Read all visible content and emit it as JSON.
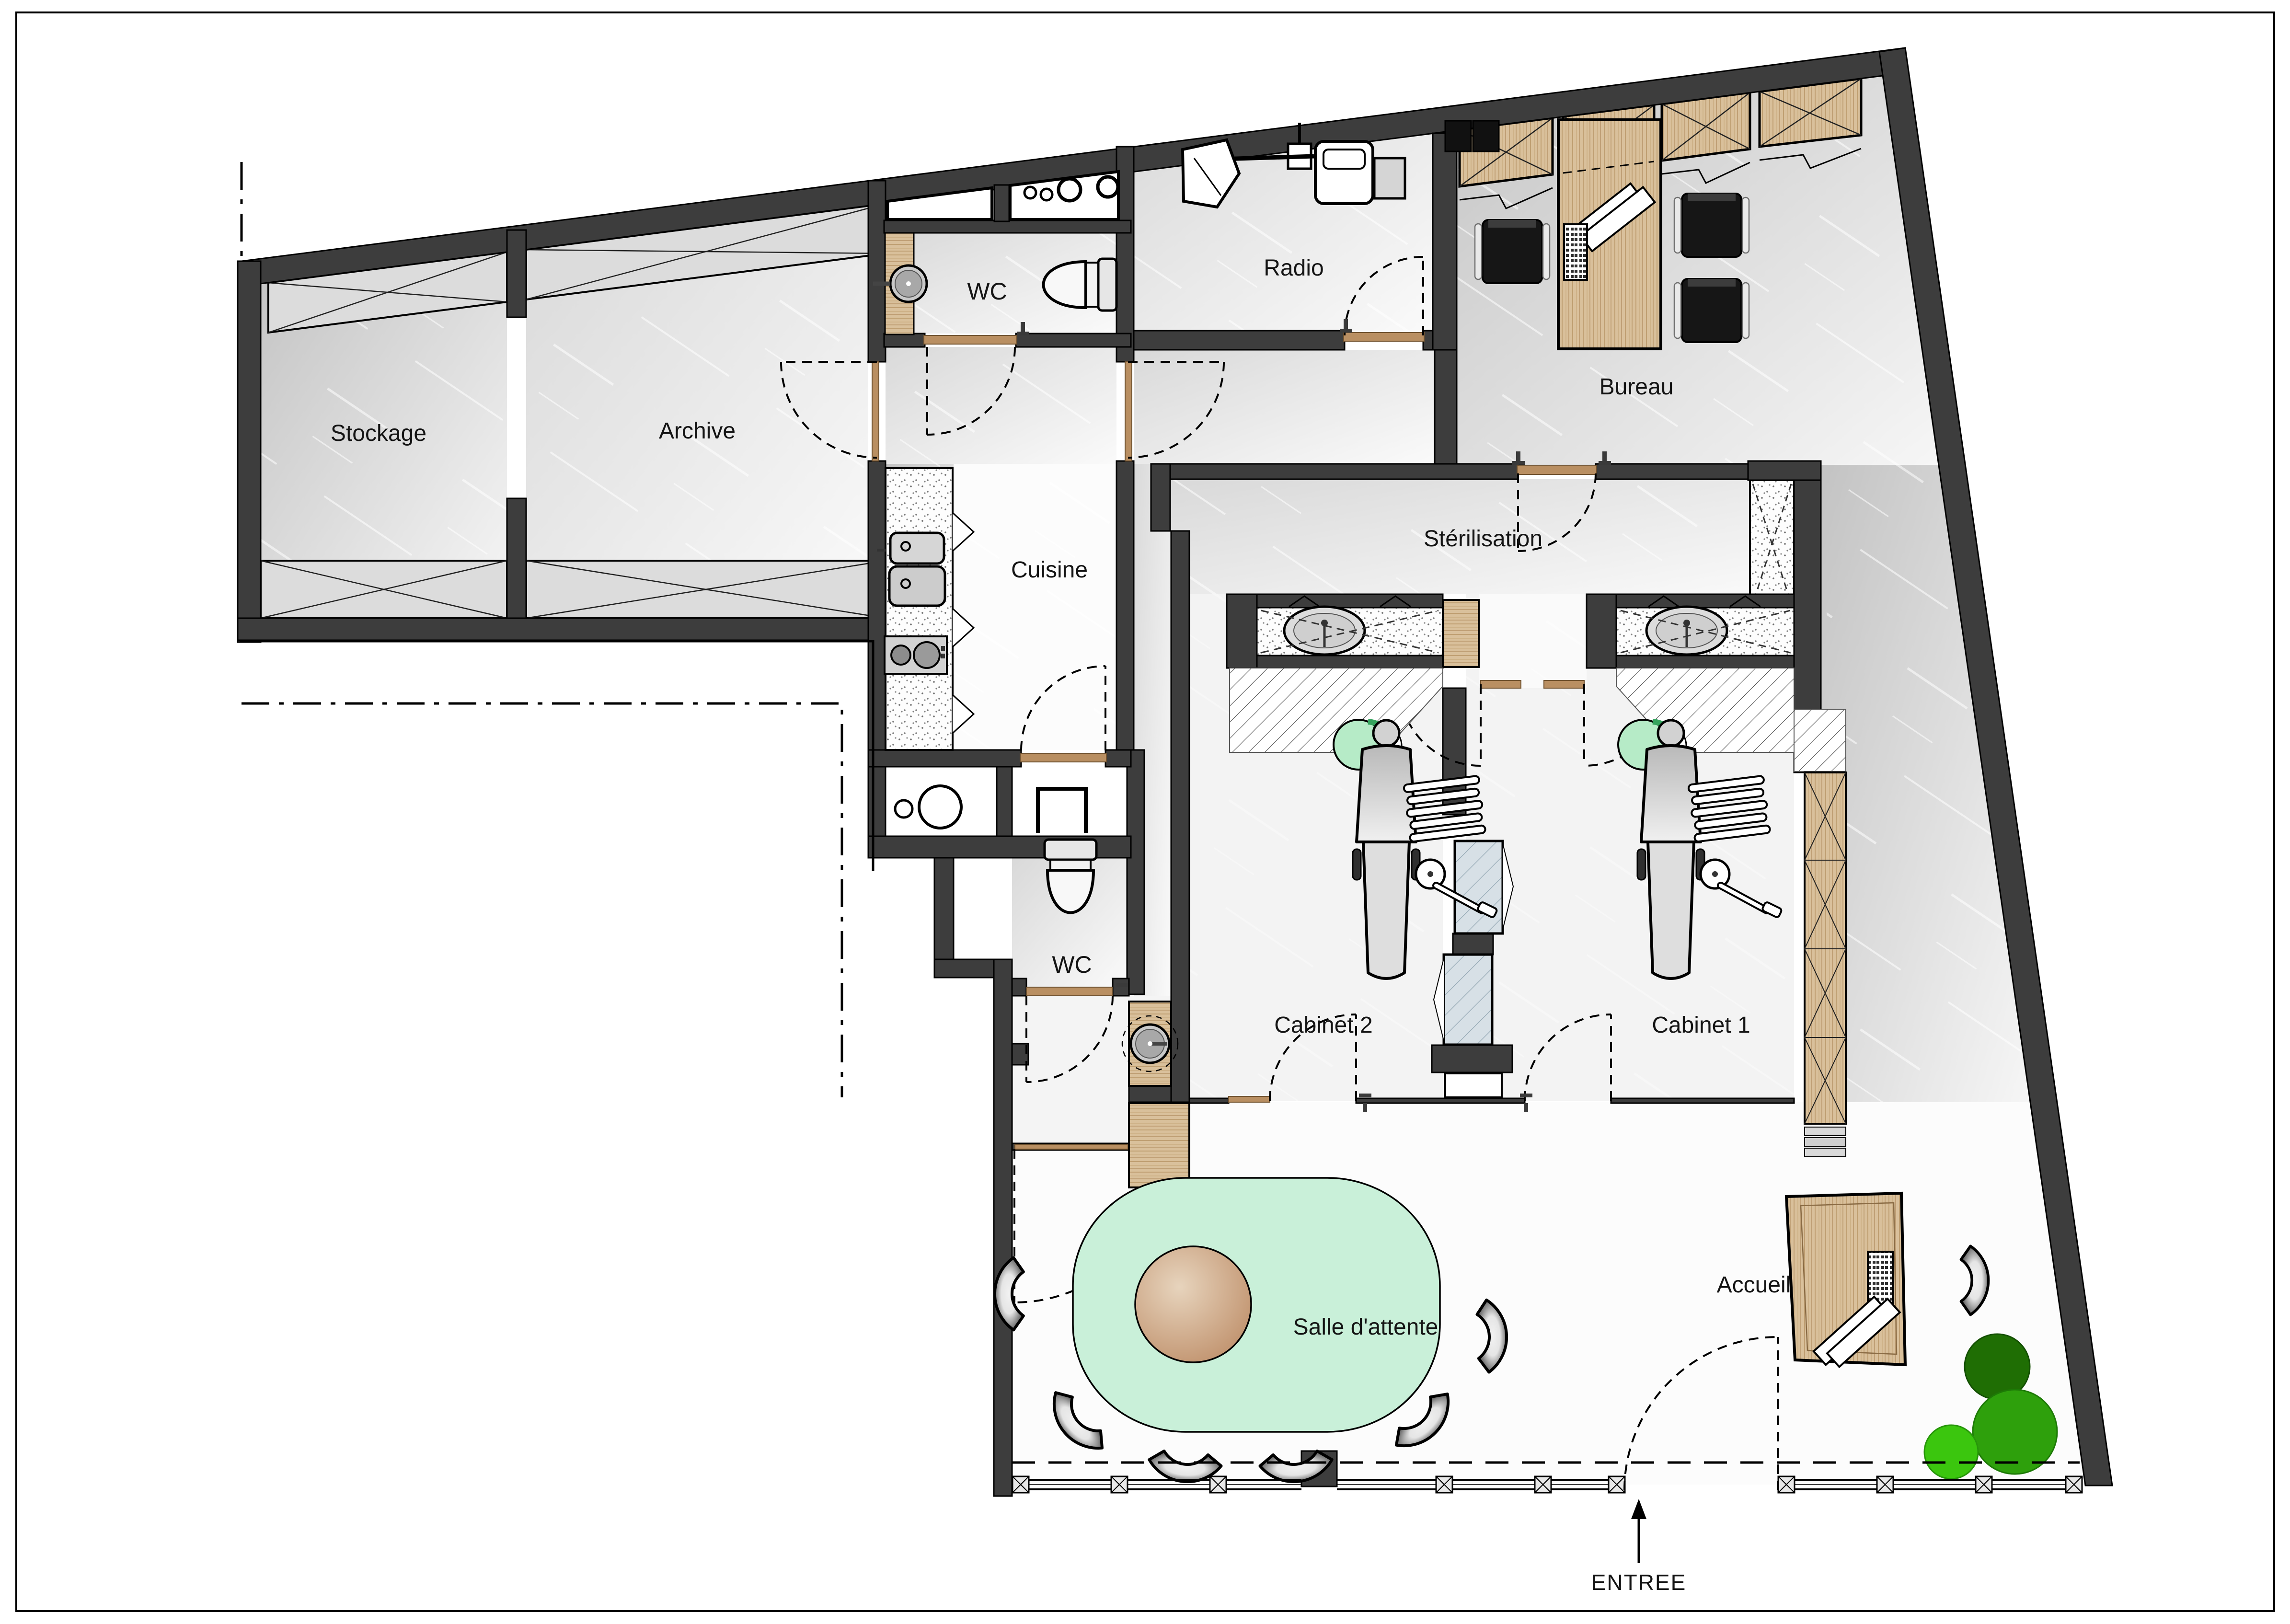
{
  "plan": {
    "type": "floor-plan",
    "language": "fr",
    "rooms": [
      {
        "id": "stockage",
        "label": "Stockage"
      },
      {
        "id": "archive",
        "label": "Archive"
      },
      {
        "id": "wc-top",
        "label": "WC"
      },
      {
        "id": "radio",
        "label": "Radio"
      },
      {
        "id": "bureau",
        "label": "Bureau"
      },
      {
        "id": "cuisine",
        "label": "Cuisine"
      },
      {
        "id": "sterilisation",
        "label": "Stérilisation"
      },
      {
        "id": "cabinet-2",
        "label": "Cabinet 2"
      },
      {
        "id": "cabinet-1",
        "label": "Cabinet 1"
      },
      {
        "id": "wc-bottom",
        "label": "WC"
      },
      {
        "id": "salle-attente",
        "label": "Salle d'attente"
      },
      {
        "id": "accueil",
        "label": "Accueil"
      }
    ],
    "entrance": {
      "label": "ENTREE"
    },
    "colors": {
      "wall": "#3d3d3d",
      "wood": "#d9c09b",
      "threshold_wood": "#b98f62",
      "mint_rug": "#c9f0d9",
      "stool_green": "#b6ebc7",
      "table_brown": "#c29270",
      "plant_dark": "#1f6e04",
      "plant_mid": "#2ea00c",
      "plant_light": "#3bc60e",
      "glass_partition": "#d7e0e6",
      "floor_gray": "#d9d9d9"
    },
    "fixtures": [
      "storage-shelves-x",
      "wardrobe-cabinets-x",
      "office-desk",
      "office-chairs",
      "xray-unit",
      "toilet",
      "washbasin",
      "kitchen-counter-double-sink",
      "cooktop",
      "sterilization-counter-sink",
      "dental-chair",
      "instrument-tray",
      "dentist-stool",
      "glass-partition",
      "wood-cabinet-column",
      "corner-washbasin",
      "waiting-rug",
      "round-table",
      "waiting-chairs",
      "reception-desk",
      "keyboard",
      "papers",
      "plants",
      "glazed-facade",
      "entrance-door",
      "property-boundary"
    ]
  }
}
